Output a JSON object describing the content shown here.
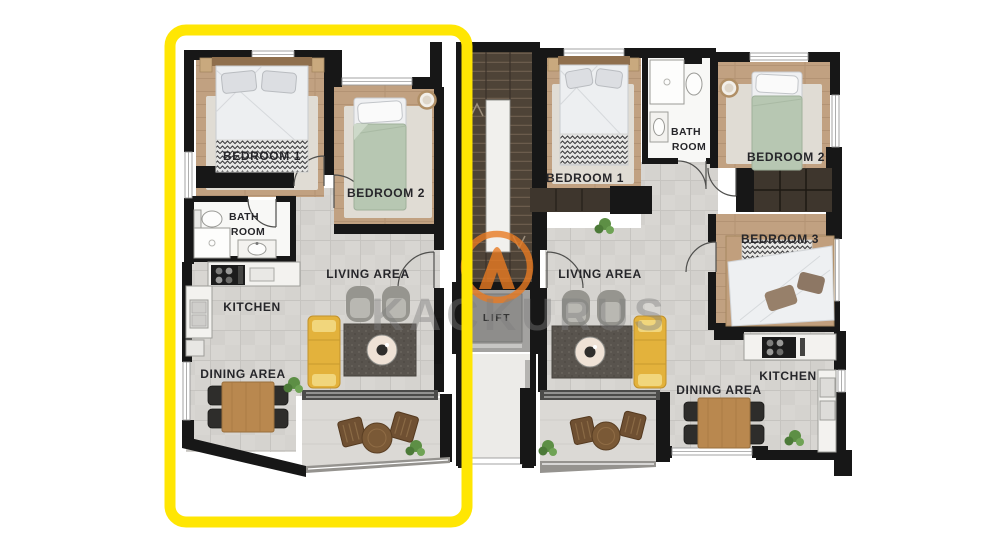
{
  "colors": {
    "highlight": "#FFE603",
    "logo": "#E87A22",
    "watermark": "#7E7E7E",
    "sofa": "#E3B23C"
  },
  "watermark": {
    "text": "KACKURUS"
  },
  "core": {
    "lift_label": "LIFT"
  },
  "left_unit": {
    "labels": {
      "bedroom1": "BEDROOM 1",
      "bedroom2": "BEDROOM 2",
      "bath_line1": "BATH",
      "bath_line2": "ROOM",
      "kitchen": "KITCHEN",
      "living": "LIVING AREA",
      "dining": "DINING AREA"
    }
  },
  "right_unit": {
    "labels": {
      "bedroom1": "BEDROOM 1",
      "bedroom2": "BEDROOM 2",
      "bedroom3": "BEDROOM 3",
      "bath_line1": "BATH",
      "bath_line2": "ROOM",
      "kitchen": "KITCHEN",
      "living": "LIVING AREA",
      "dining": "DINING AREA"
    }
  }
}
